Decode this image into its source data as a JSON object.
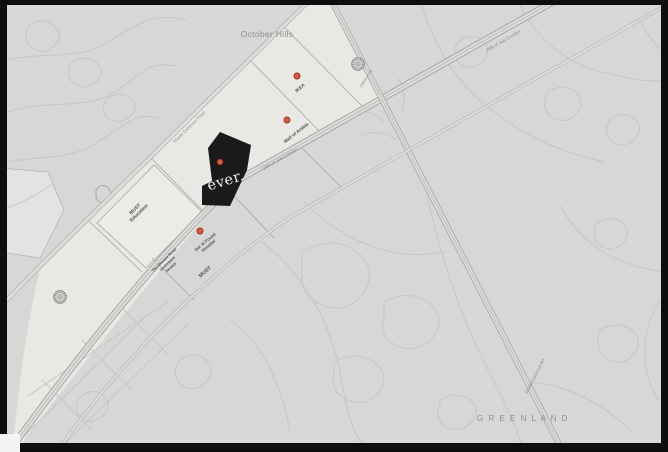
{
  "title": "Location map",
  "map": {
    "background": "#d8d7d5",
    "strip_fill": "#eae8e5",
    "accent": "#d95b41",
    "marker_ring": "#8e3123",
    "site": {
      "name": "ever.",
      "fill": "#1a1a1a",
      "text_color": "#f3efe8"
    },
    "area_labels": [
      {
        "id": "october-hills",
        "text": "October Hills"
      },
      {
        "id": "greenland",
        "text": "G R E E N L A N D"
      }
    ],
    "road_labels": [
      {
        "id": "waslet-dahshour-road-nw",
        "text": "Waslet Dahshour Road"
      },
      {
        "id": "july26-corridor-sw",
        "text": "26th of July Corridor"
      },
      {
        "id": "july26-corridor-ne",
        "text": "26th of July Corridor"
      },
      {
        "id": "dahshur-rd",
        "text": "Dahshur Rd"
      },
      {
        "id": "waslet-dahshour-rd-se",
        "text": "Waslet Dahshour Rd"
      }
    ],
    "pois": [
      {
        "id": "ikea",
        "text": "IKEA"
      },
      {
        "id": "mall-of-arabia",
        "text": "Mall of Arabia"
      },
      {
        "id": "dar-al-fouad",
        "line1": "Dar Al Fouad",
        "line2": "Hospital"
      },
      {
        "id": "must",
        "text": "MUST"
      },
      {
        "id": "must-education",
        "line1": "MUST",
        "line2": "Education"
      },
      {
        "id": "mosque-road",
        "line1": "The Mosque Road",
        "line2": "Underpass",
        "line3": "Hosary"
      }
    ]
  }
}
